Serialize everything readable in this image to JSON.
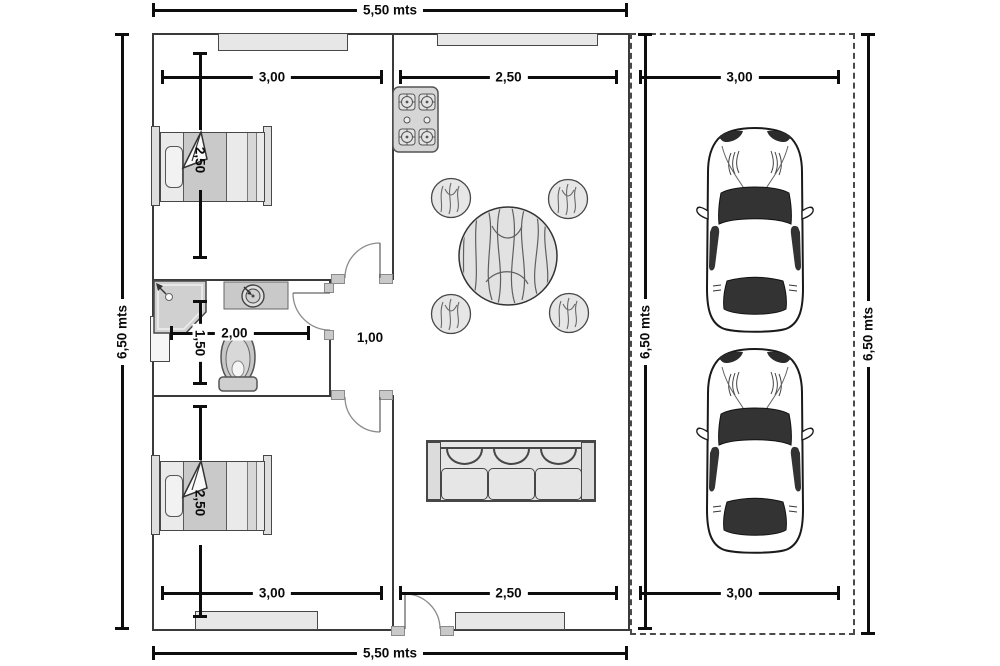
{
  "dimensions": {
    "overall_width_top": "5,50 mts",
    "overall_width_bottom": "5,50 mts",
    "overall_height_left": "6,50 mts",
    "overall_height_right": "6,50 mts",
    "garage_height": "6,50 mts",
    "bedroom1_width": "3,00",
    "kitchen_width": "2,50",
    "garage_width_top": "3,00",
    "bedroom2_width": "3,00",
    "living_width": "2,50",
    "garage_width_bottom": "3,00",
    "bedroom1_depth": "2,50",
    "bedroom2_depth": "2,50",
    "bathroom_width": "2,00",
    "bathroom_depth": "1,50",
    "hallway_width": "1,00"
  },
  "colors": {
    "wall": "#3a3a3a",
    "dimension": "#0d0d0d",
    "furniture_fill": "#e6e6e6",
    "glass": "#333333"
  }
}
